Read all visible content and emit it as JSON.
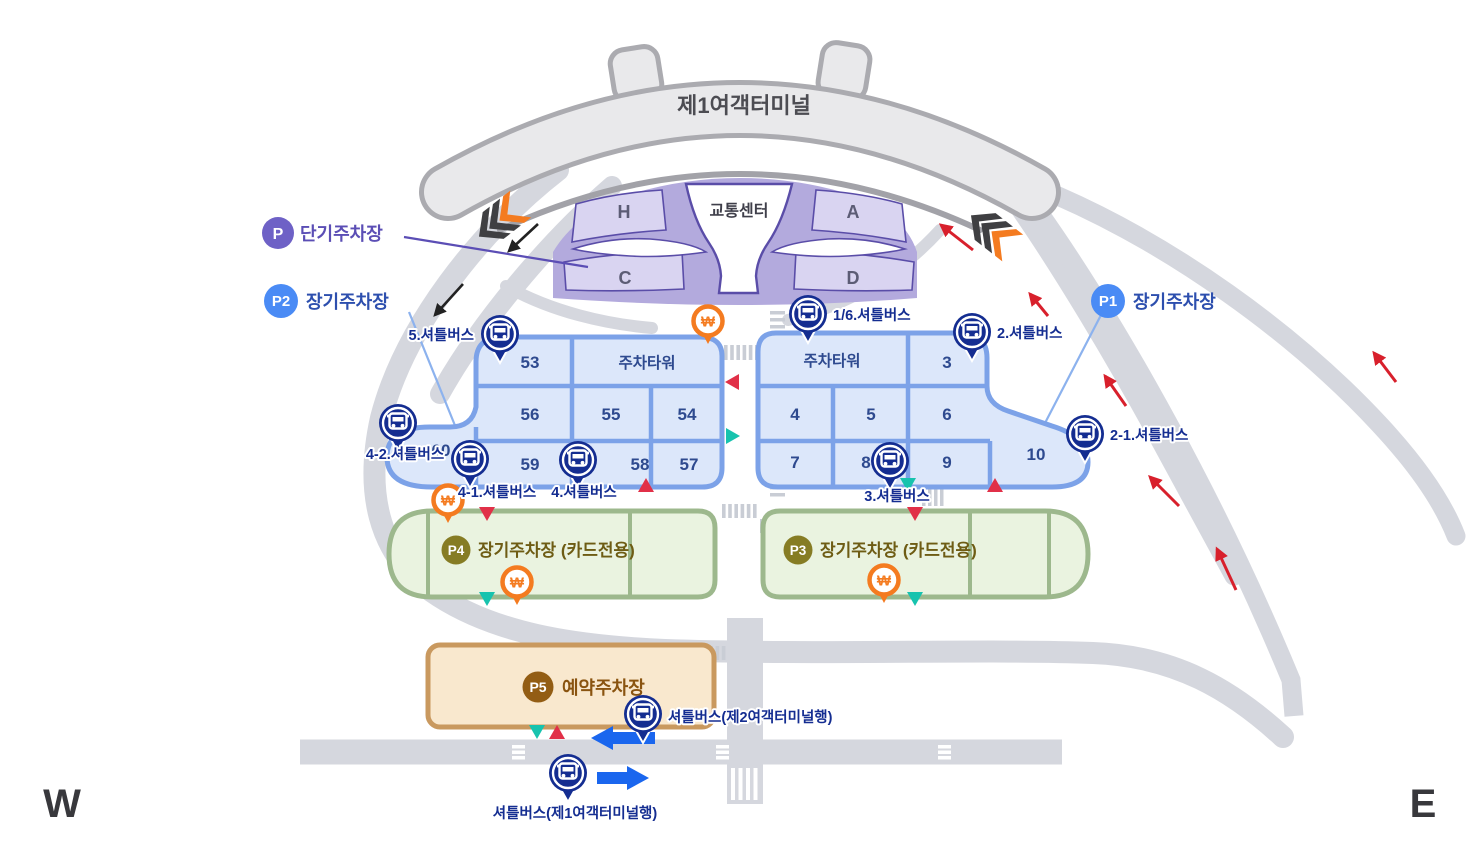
{
  "map": {
    "terminal": {
      "label": "제1여객터미널"
    },
    "transport_center": {
      "label": "교통센터"
    },
    "short_term_sections": {
      "h": "H",
      "a": "A",
      "c": "C",
      "d": "D"
    },
    "legend": {
      "p": {
        "badge": "P",
        "label": "단기주차장"
      },
      "p2": {
        "badge": "P2",
        "label": "장기주차장"
      },
      "p1": {
        "badge": "P1",
        "label": "장기주차장"
      },
      "p4": {
        "badge": "P4",
        "label": "장기주차장 (카드전용)"
      },
      "p3": {
        "badge": "P3",
        "label": "장기주차장 (카드전용)"
      },
      "p5": {
        "badge": "P5",
        "label": "예약주차장"
      }
    },
    "west_block": {
      "c53": "53",
      "tower": "주차타워",
      "c56": "56",
      "c55": "55",
      "c54": "54",
      "c60": "60",
      "c59": "59",
      "c58": "58",
      "c57": "57"
    },
    "east_block": {
      "tower": "주차타워",
      "c3": "3",
      "c4": "4",
      "c5": "5",
      "c6": "6",
      "c7": "7",
      "c8": "8",
      "c9": "9",
      "c10": "10"
    },
    "bus_stops": {
      "s5": "5.셔틀버스",
      "s16": "1/6.셔틀버스",
      "s2": "2.셔틀버스",
      "s42": "4-2.셔틀버스",
      "s41": "4-1.셔틀버스",
      "s4": "4.셔틀버스",
      "s3": "3.셔틀버스",
      "s21": "2-1.셔틀버스",
      "t2": "셔틀버스(제2여객터미널행)",
      "t1": "셔틀버스(제1여객터미널행)"
    },
    "fee_booth_symbol": "₩",
    "compass": {
      "west": "W",
      "east": "E"
    },
    "colors": {
      "bus_pin": "#142d91",
      "fee_pin": "#f47b20",
      "teal_marker": "#17c3ae",
      "red_marker": "#e13048",
      "short_term_fill": "#b3aadd",
      "long_term_fill": "#dce7fa",
      "card_only_fill": "#eaf3e0",
      "reserved_fill": "#f9e8ce",
      "road": "#d5d7de"
    }
  }
}
